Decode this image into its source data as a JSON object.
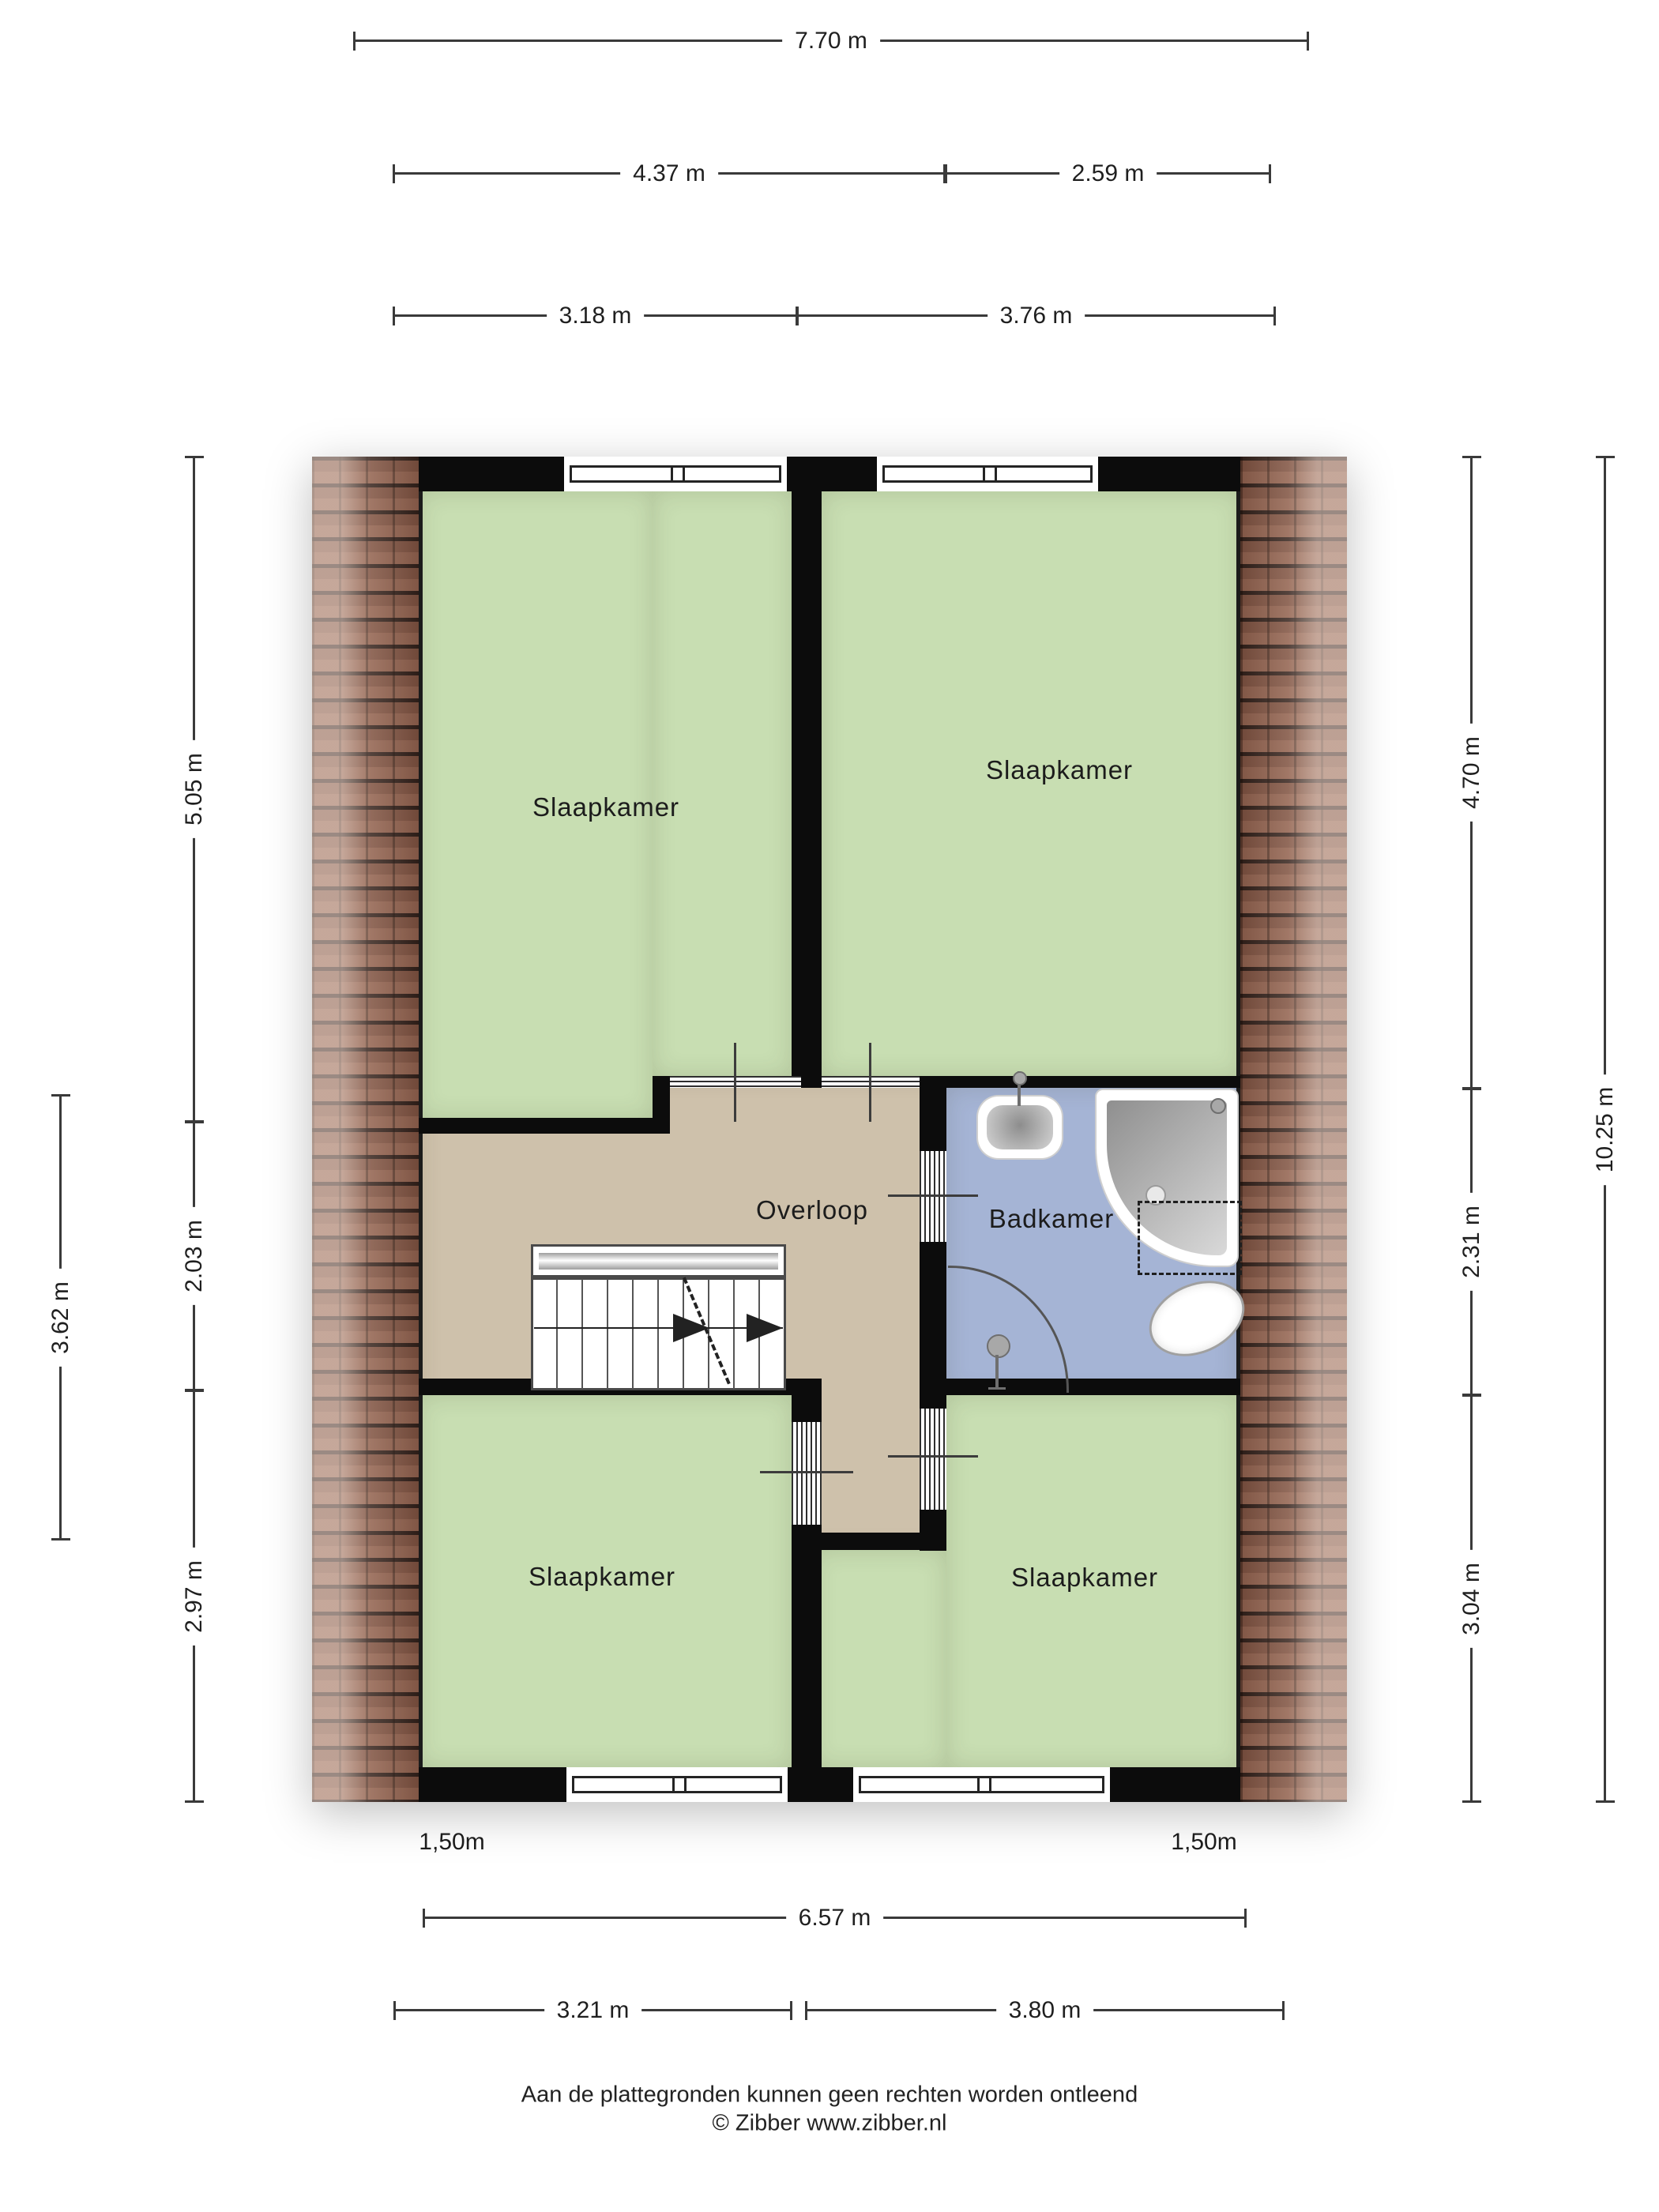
{
  "rooms": {
    "bedroom_top_left": {
      "label": "Slaapkamer"
    },
    "bedroom_top_right": {
      "label": "Slaapkamer"
    },
    "bedroom_bottom_left": {
      "label": "Slaapkamer"
    },
    "bedroom_bottom_right": {
      "label": "Slaapkamer"
    },
    "landing": {
      "label": "Overloop"
    },
    "bathroom": {
      "label": "Badkamer"
    }
  },
  "dimensions": {
    "top_total": "7.70 m",
    "top_left": "4.37 m",
    "top_right": "2.59 m",
    "top_left_inner": "3.18 m",
    "top_right_inner": "3.76 m",
    "bottom_total": "6.57 m",
    "bottom_left": "3.21 m",
    "bottom_right": "3.80 m",
    "left_outer": "3.62 m",
    "left_top": "5.05 m",
    "left_mid": "2.03 m",
    "left_bottom": "2.97 m",
    "right_top": "4.70 m",
    "right_mid": "2.31 m",
    "right_bottom": "3.04 m",
    "right_outer": "10.25 m",
    "knee_height_left": "1,50m",
    "knee_height_right": "1,50m"
  },
  "footer": {
    "disclaimer": "Aan de plattegronden kunnen geen rechten worden ontleend",
    "credit": "© Zibber www.zibber.nl"
  },
  "colors": {
    "room_green": "#c8deb2",
    "landing_tan": "#cec1ab",
    "bath_blue": "#a5b4d5",
    "wall_black": "#0c0c0c",
    "roof_brown": "#7d5140",
    "dim_line": "#3a3a3a"
  }
}
